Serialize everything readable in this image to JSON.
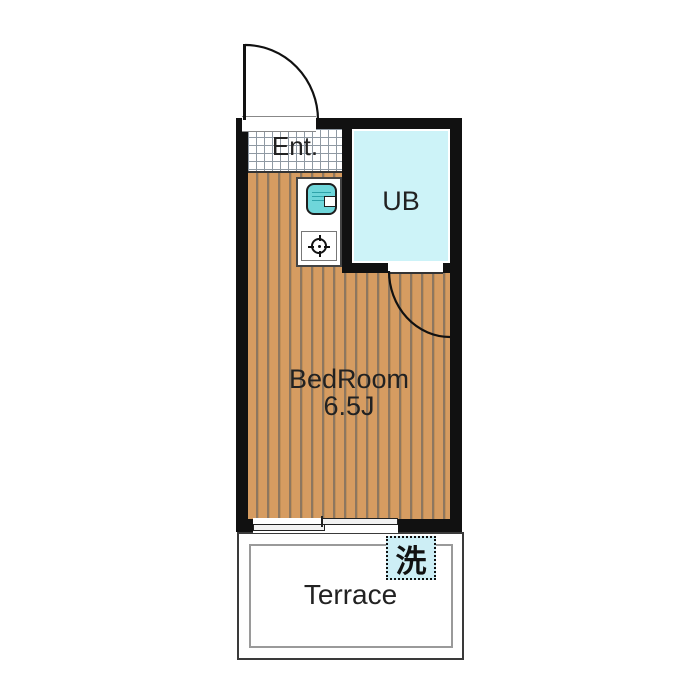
{
  "rooms": {
    "entrance": {
      "label": "Ent."
    },
    "unit_bath": {
      "label": "UB"
    },
    "bedroom": {
      "label": "BedRoom",
      "size": "6.5J"
    },
    "terrace": {
      "label": "Terrace"
    },
    "washing_machine": {
      "label": "洗"
    }
  },
  "icons": [
    "entrance-door-swing-arc-icon",
    "ub-door-swing-arc-icon",
    "sink-icon",
    "stove-burner-icon",
    "sliding-window-icon",
    "washing-machine-box"
  ],
  "colors": {
    "wall": "#111111",
    "wood_base": "#d69c61",
    "wood_stripe": "#8d7760",
    "ub_fill": "#cdf3f8",
    "sink_fill": "#6fd6da",
    "washer_fill": "#cdeef5",
    "tile_grid_line": "#8f99a3",
    "text": "#222222"
  }
}
